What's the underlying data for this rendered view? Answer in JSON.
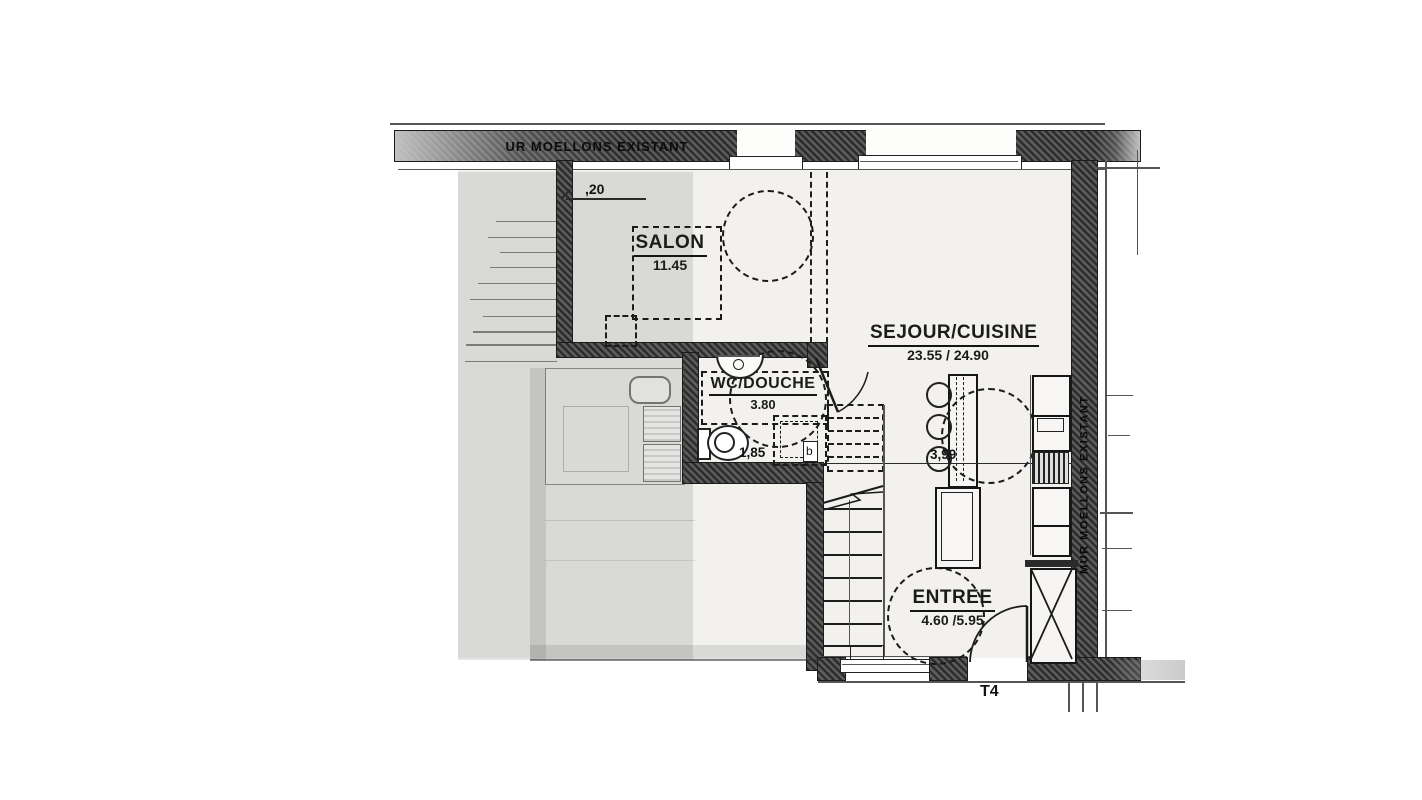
{
  "plan": {
    "title": "T4",
    "wall_labels": {
      "top": "UR MOELLONS EXISTANT",
      "right": "MUR MOELLONS EXISTANT"
    },
    "rooms": {
      "salon": {
        "name": "SALON",
        "area": "11.45"
      },
      "sejour": {
        "name": "SEJOUR/CUISINE",
        "area": "23.55 / 24.90"
      },
      "wc": {
        "name": "WC/DOUCHE",
        "area": "3.80"
      },
      "entree": {
        "name": "ENTREE",
        "area": "4.60 /5.95"
      }
    },
    "dimensions": {
      "partition": ",20",
      "wc": "1,85",
      "kitchen": "3,99"
    },
    "markers": {
      "door_b": "b"
    },
    "colors": {
      "wall": "#3d3d3d",
      "ink": "#1b1b1b",
      "room_fill": "#f2f1ee"
    }
  }
}
